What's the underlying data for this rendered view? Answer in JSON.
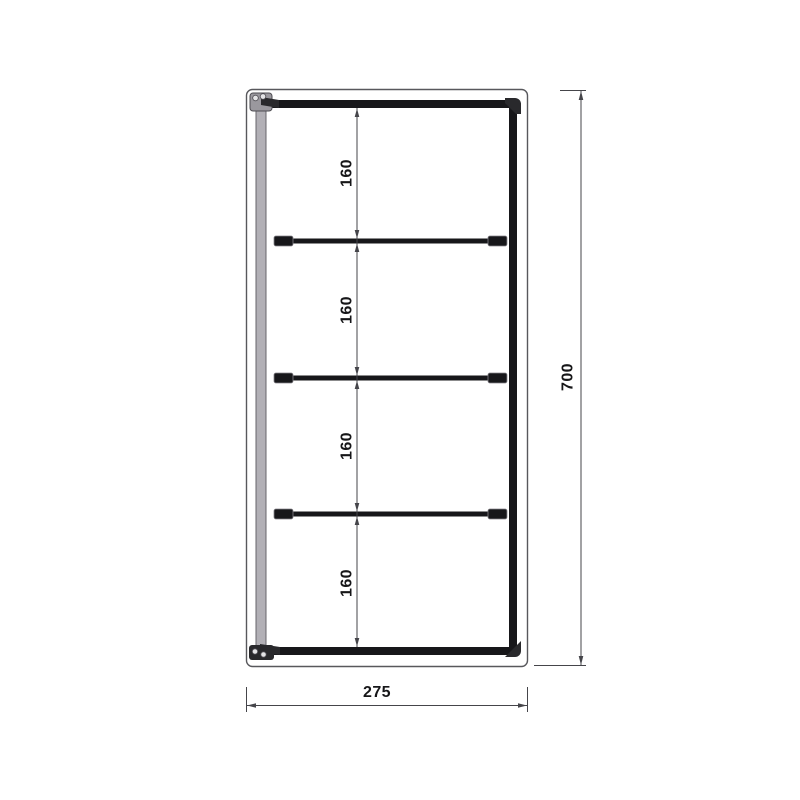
{
  "drawing": {
    "type": "dimensioned-frame-elevation",
    "overall": {
      "height_label": "700",
      "width_label": "275"
    },
    "spacings": [
      "160",
      "160",
      "160",
      "160"
    ],
    "structure": {
      "shelf_rail_count": 3,
      "corner_fitting_count": 4
    },
    "colors": {
      "bar_black": "#17171a",
      "profile_gray": "#b2b0b6",
      "profile_edge": "#67656b",
      "outline": "#58585c",
      "dim_line": "#45454a",
      "text_color": "#161618",
      "fitting_dark": "#29292c",
      "fitting_gray": "#9a989e",
      "screw": "#e4e4e6",
      "background": "#ffffff"
    }
  }
}
